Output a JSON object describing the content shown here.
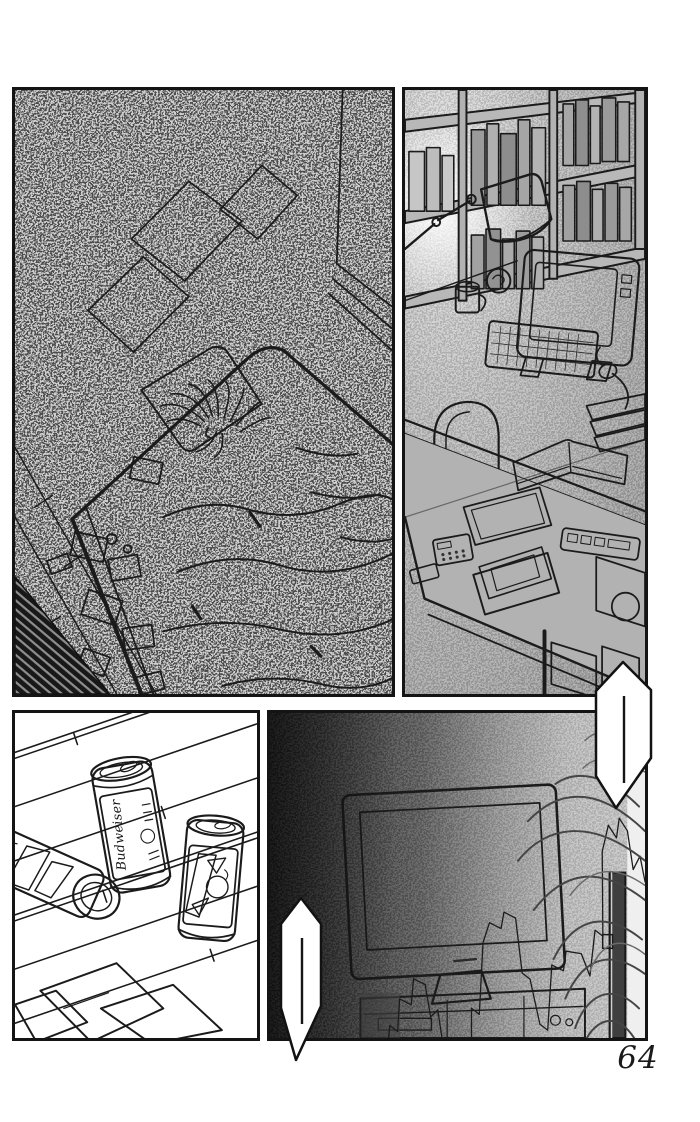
{
  "page": {
    "number": "64"
  },
  "colors": {
    "page_bg": "#ffffff",
    "ink": "#1a1a1a",
    "panel_border": "#141414",
    "noise_gray": "#9d9d9d",
    "desk_tone": "#a8a8a8",
    "dark_room": "#262626",
    "screen_white": "#f6f6f6"
  },
  "panels": [
    {
      "id": "bedroom"
    },
    {
      "id": "desk"
    },
    {
      "id": "beer-cans"
    },
    {
      "id": "television"
    }
  ],
  "beer_can": {
    "brand_label": "Budweiser"
  },
  "speech_bubbles": [
    {
      "id": "upper-right",
      "shape": "elongated-hexagon",
      "content": "silence-dash"
    },
    {
      "id": "lower-left",
      "shape": "elongated-hexagon",
      "content": "silence-dash"
    }
  ],
  "chart_data": {
    "type": "line",
    "title": "",
    "xlabel": "",
    "ylabel": "",
    "axes_visible": false,
    "grid": false,
    "displayed_on": "tv-screen",
    "x_range": [
      0,
      100
    ],
    "y_range": [
      0,
      100
    ],
    "points": [
      [
        3,
        82
      ],
      [
        5,
        66
      ],
      [
        7,
        68
      ],
      [
        8,
        58
      ],
      [
        11,
        60
      ],
      [
        12,
        52
      ],
      [
        15,
        54
      ],
      [
        16,
        64
      ],
      [
        18,
        62
      ],
      [
        19,
        74
      ],
      [
        22,
        76
      ],
      [
        24,
        86
      ],
      [
        26,
        84
      ],
      [
        27,
        62
      ],
      [
        29,
        64
      ],
      [
        31,
        42
      ],
      [
        33,
        36
      ],
      [
        36,
        38
      ],
      [
        37,
        33
      ],
      [
        40,
        35
      ],
      [
        41,
        52
      ],
      [
        43,
        54
      ],
      [
        45,
        68
      ],
      [
        47,
        70
      ],
      [
        49,
        50
      ],
      [
        52,
        52
      ],
      [
        53,
        46
      ],
      [
        57,
        47
      ],
      [
        59,
        54
      ],
      [
        61,
        40
      ],
      [
        63,
        42
      ],
      [
        64,
        16
      ],
      [
        66,
        8
      ],
      [
        68,
        12
      ],
      [
        69,
        6
      ],
      [
        71,
        10
      ],
      [
        72,
        22
      ],
      [
        74,
        18
      ],
      [
        75,
        26
      ],
      [
        77,
        24
      ],
      [
        78,
        40
      ],
      [
        80,
        44
      ],
      [
        82,
        52
      ],
      [
        84,
        58
      ],
      [
        86,
        62
      ],
      [
        88,
        66
      ]
    ],
    "underline_strokes": [
      [
        [
          27,
          93
        ],
        [
          37,
          93
        ],
        [
          41,
          91
        ],
        [
          45,
          85
        ]
      ],
      [
        [
          47,
          91
        ],
        [
          58,
          90
        ]
      ]
    ]
  }
}
